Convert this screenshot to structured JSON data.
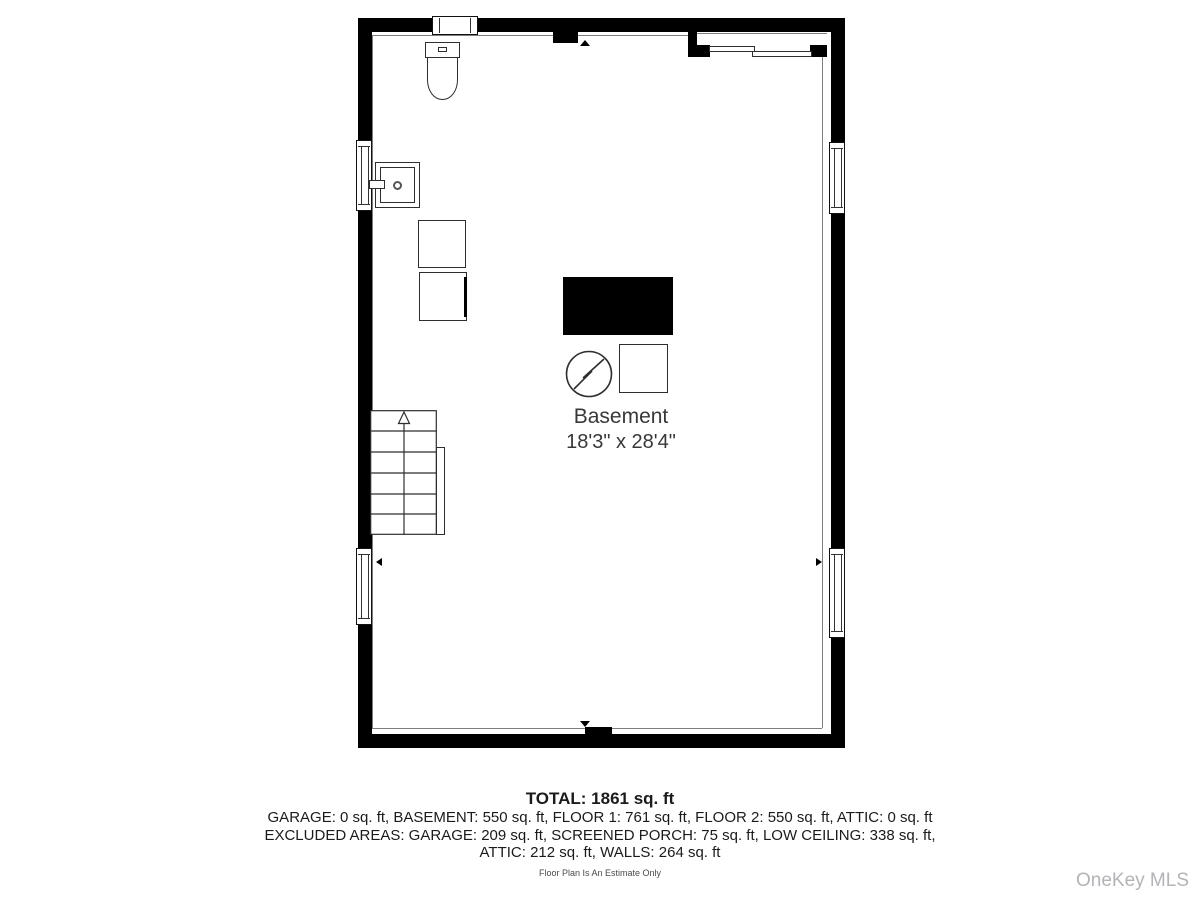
{
  "room_label": {
    "name": "Basement",
    "dims": "18'3\" x 28'4\""
  },
  "summary": {
    "total": "TOTAL: 1861 sq. ft",
    "line2": "GARAGE: 0 sq. ft, BASEMENT: 550 sq. ft, FLOOR 1: 761 sq. ft, FLOOR 2: 550 sq. ft, ATTIC: 0 sq. ft",
    "line3": "EXCLUDED AREAS: GARAGE: 209 sq. ft, SCREENED PORCH: 75 sq. ft, LOW CEILING: 338 sq. ft,",
    "line4": "ATTIC: 212 sq. ft, WALLS: 264 sq. ft",
    "disclaimer": "Floor Plan Is An Estimate Only"
  },
  "watermark": "OneKey MLS",
  "fixtures": [
    "toilet-icon",
    "sink-icon",
    "storage-box-1",
    "storage-box-2",
    "furnace-unit",
    "electric-panel-icon",
    "water-tank",
    "stairs-up",
    "stair-rail",
    "sliding-door",
    "window-top",
    "window-left-upper",
    "window-left-lower",
    "window-right-upper",
    "window-right-lower"
  ],
  "colors": {
    "wall": "#000000",
    "fixture_line": "#2e2e2e",
    "interior_line": "#7d7d7d",
    "text": "#1b1b1b",
    "watermark": "#b3b3b8"
  }
}
